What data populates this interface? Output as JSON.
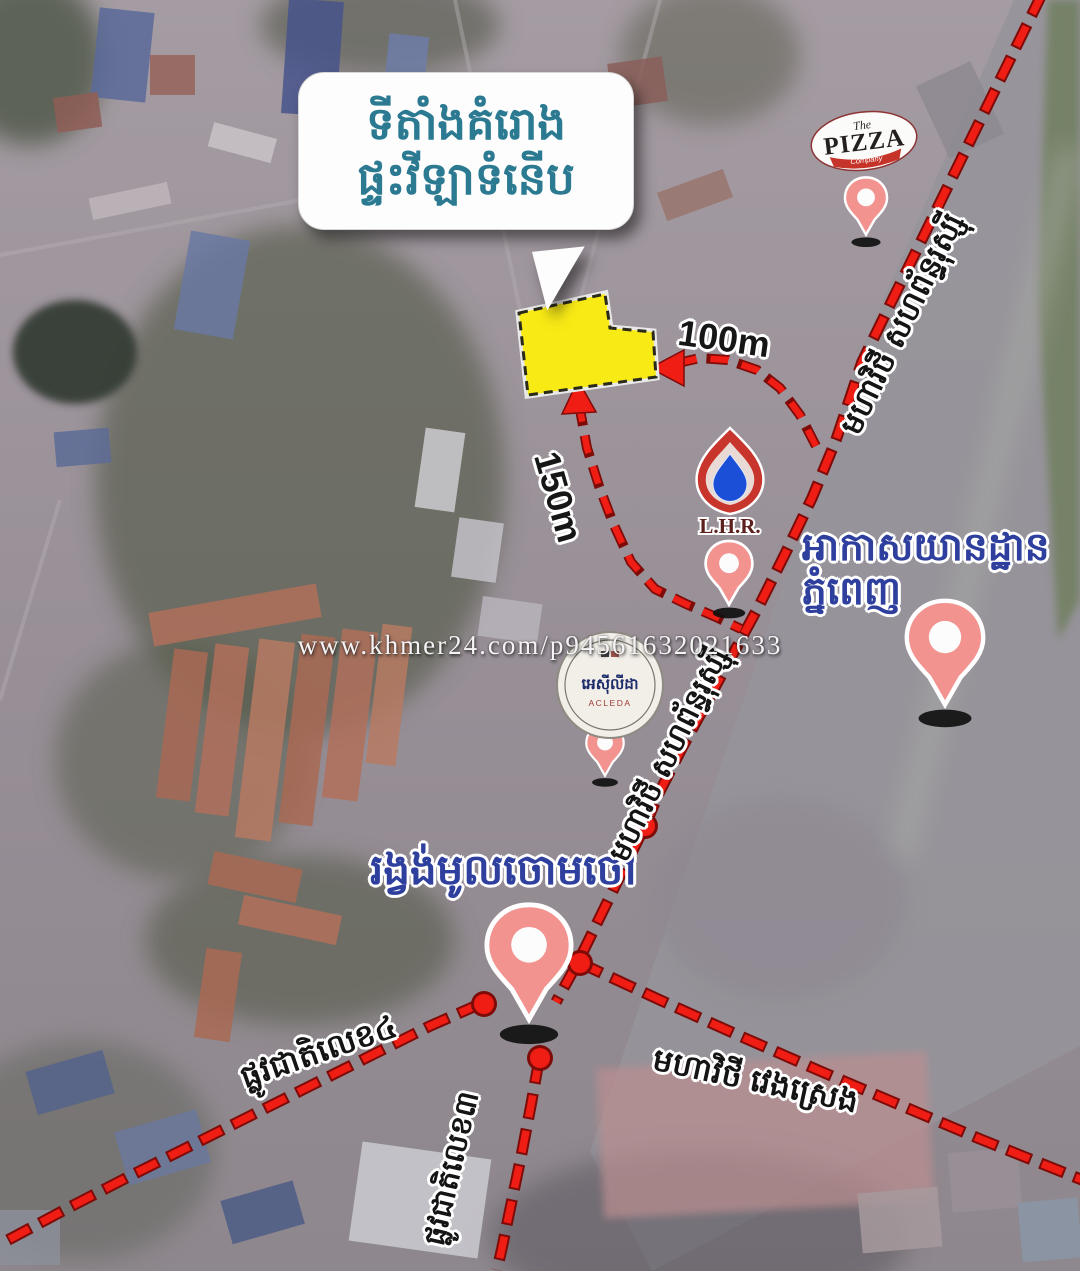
{
  "watermark": "www.khmer24.com/p94561632021633",
  "callout": {
    "line1": "ទីតាំងគំរោង",
    "line2": "ផ្ទះវីឡាទំនើប"
  },
  "distances": {
    "east_path": "100m",
    "south_path": "150m"
  },
  "pois": {
    "pizza_company": {
      "the": "The",
      "pizza": "PIZZA",
      "company": "Company"
    },
    "lhr": {
      "label": "L.H.R."
    },
    "acleda": {
      "khmer": "អេស៊ីលីដា",
      "latin": "ACLEDA"
    },
    "airport": {
      "line1": "អាកាសយានដ្ឋាន",
      "line2": "ភ្នំពេញ"
    },
    "roundabout": {
      "label": "រង្វង់មូលចោមចៅ"
    }
  },
  "roads": {
    "russian_blvd_upper": "មហាវិថី សហព័ន្ធរុស្ស៊ី",
    "russian_blvd_lower": "មហាវិថី សហព័ន្ធរុស្ស៊ី",
    "veng_sreng_blvd": "មហាវិថី វេងស្រេង",
    "national_road_4": "ផ្លូវជាតិលេខ៤",
    "national_road_3": "ផ្លូវជាតិលេខ៣"
  },
  "colors": {
    "route_red": "#e8100c",
    "pin_pink": "#f29390",
    "plot_yellow": "#f8ea15",
    "callout_teal": "#2b7a92",
    "poi_label_blue": "#2e3f9e"
  }
}
